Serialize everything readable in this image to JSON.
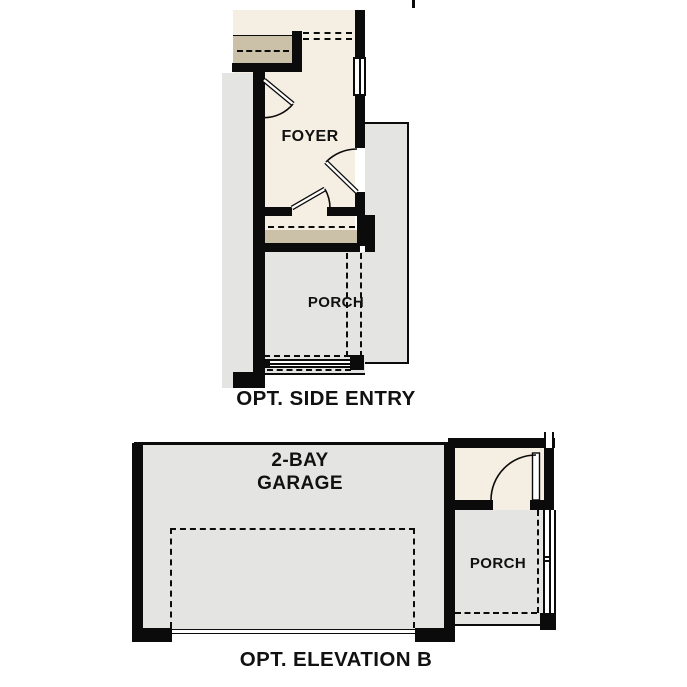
{
  "document": {
    "type": "floor-plan-options",
    "background": "#ffffff"
  },
  "colors": {
    "wall": "#0b0b0b",
    "interior-floor": "#f5eee2",
    "exterior-concrete": "#e4e4e2",
    "landing-tan": "#cbc1a9",
    "label-text": "#111111"
  },
  "side_entry_plan": {
    "caption": "OPT. SIDE ENTRY",
    "foyer_label": "FOYER",
    "porch_label": "PORCH"
  },
  "elevation_b_plan": {
    "caption": "OPT. ELEVATION B",
    "garage_label_line1": "2-BAY",
    "garage_label_line2": "GARAGE",
    "porch_label": "PORCH"
  }
}
